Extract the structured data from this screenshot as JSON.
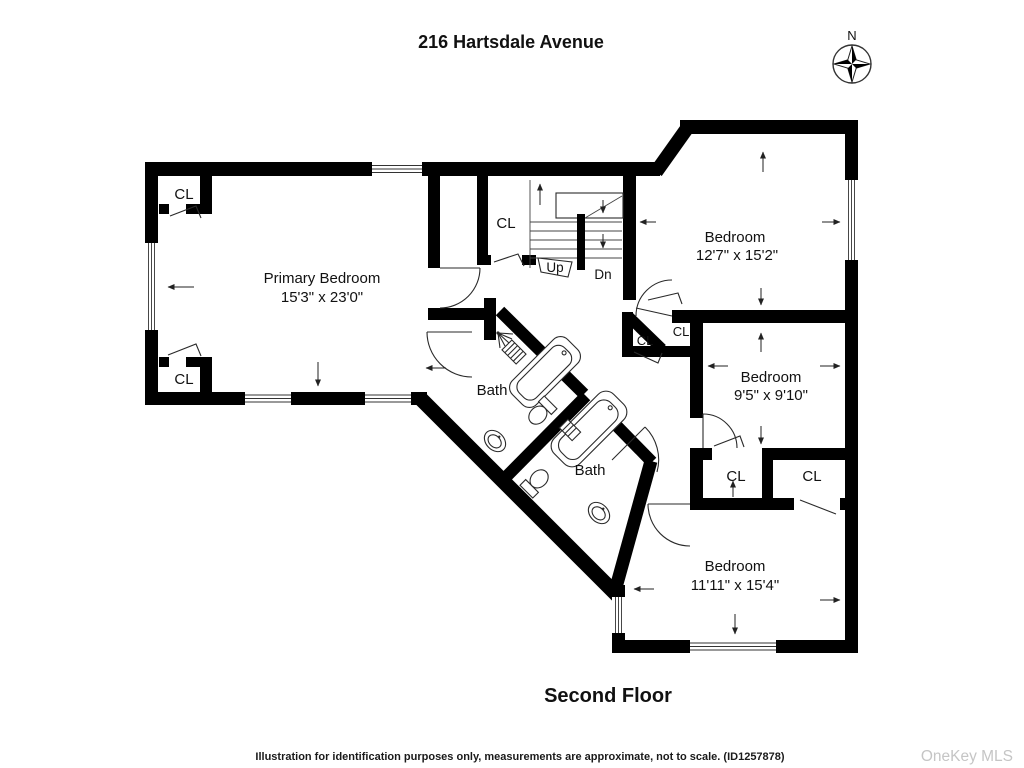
{
  "header": {
    "title": "216 Hartsdale Avenue"
  },
  "compass": {
    "north_label": "N"
  },
  "plan": {
    "rooms": {
      "primary_bedroom": {
        "name": "Primary Bedroom",
        "dims": "15'3\" x 23'0\""
      },
      "bedroom_top_right": {
        "name": "Bedroom",
        "dims": "12'7\" x 15'2\""
      },
      "bedroom_mid_right": {
        "name": "Bedroom",
        "dims": "9'5\" x 9'10\""
      },
      "bedroom_bottom_right": {
        "name": "Bedroom",
        "dims": "11'11\" x 15'4\""
      },
      "bath_upper": {
        "name": "Bath"
      },
      "bath_lower": {
        "name": "Bath"
      }
    },
    "closet_label": "CL",
    "stairs": {
      "up": "Up",
      "down": "Dn"
    }
  },
  "footer": {
    "floor_title": "Second Floor",
    "disclaimer": "Illustration for identification purposes only, measurements are approximate, not to scale. (ID1257878)",
    "watermark": "OneKey MLS"
  },
  "colors": {
    "wall": "#000000",
    "background": "#ffffff",
    "watermark_gray": "#c5c5c5"
  }
}
